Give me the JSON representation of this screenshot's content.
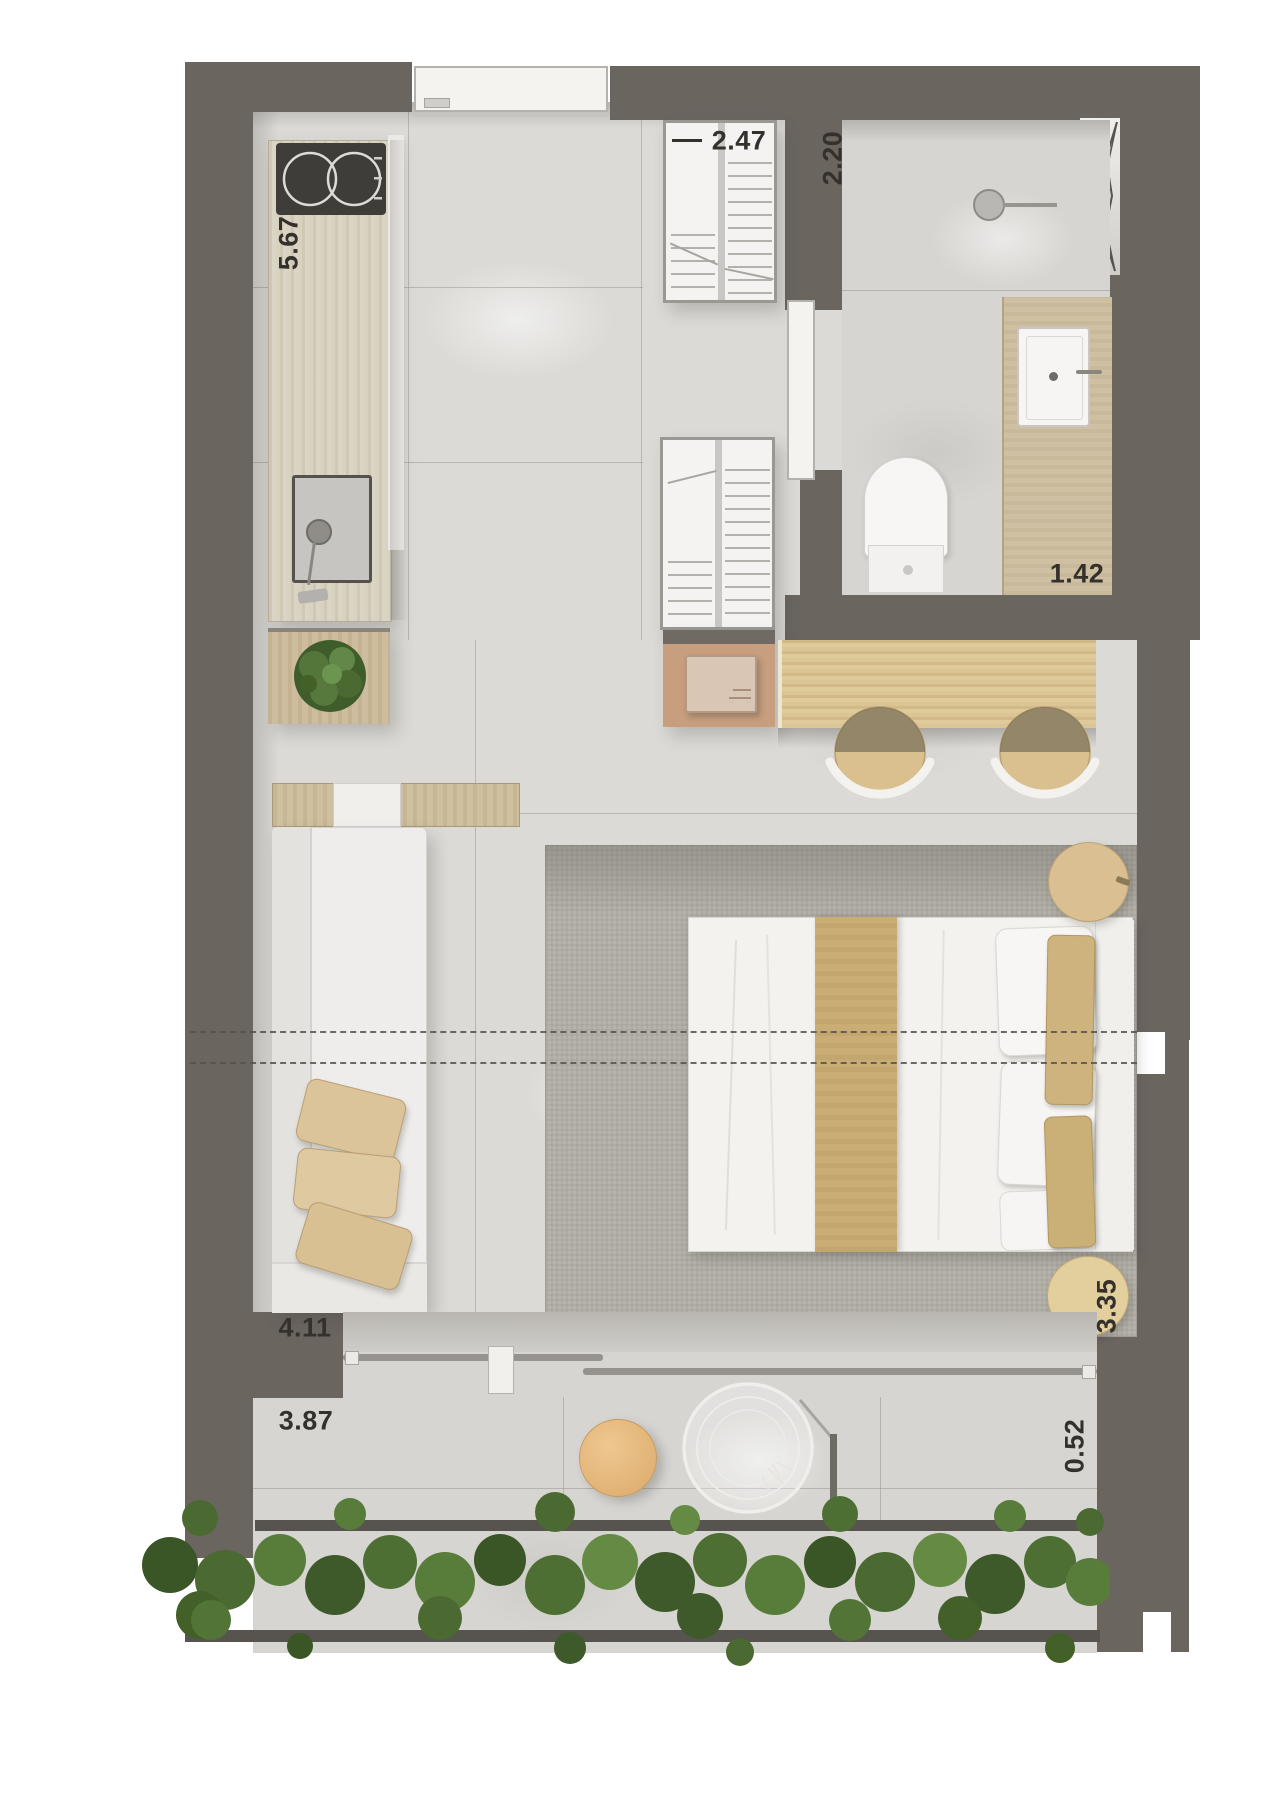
{
  "plan_type": "studio-apartment-floor-plan-top-view",
  "dims": {
    "kitchen_counter": "5.67",
    "entry_closet": "2.47",
    "bathroom_depth": "2.20",
    "vanity_width": "1.42",
    "living_width": "4.11",
    "balcony_width": "3.87",
    "bedroom_depth": "3.35",
    "balcony_depth": "0.52"
  },
  "colors": {
    "wall": "#6b6560",
    "floor_marble": "#dbdad6",
    "balcony_floor": "#d8d7d3",
    "wood_counter": "#d8d2c0",
    "wood_desk": "#dcc594",
    "bed_runner": "#c9ad74",
    "pillow_tan": "#cfb37f",
    "rug": "#b6b3ac",
    "stool": "#d9c08e",
    "balcony_table": "#e5b87e",
    "hedge_green": "#4a6a31",
    "fixture_white": "#f5f4f2",
    "dimension_text": "#34312c"
  },
  "furniture": [
    "cooktop",
    "kitchen-sink",
    "plant",
    "console",
    "sofa",
    "sofa-pillows",
    "entry-door",
    "wardrobe-closet",
    "linen-closet",
    "microwave-cabinet",
    "shower-head",
    "duct-niche",
    "vanity-sink",
    "toilet",
    "bathroom-door",
    "desk",
    "stools",
    "rug",
    "double-bed",
    "bed-pillows",
    "side-tables",
    "sliding-balcony-door",
    "balcony-table",
    "hanging-chair",
    "hedge-planter"
  ]
}
